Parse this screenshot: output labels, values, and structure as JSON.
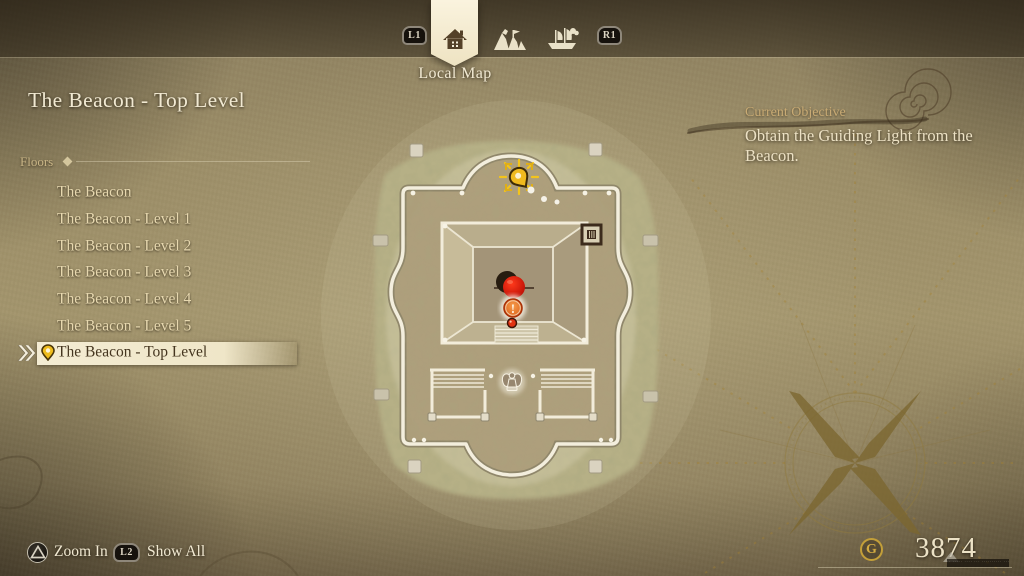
{
  "header": {
    "left_bumper_label": "L1",
    "right_bumper_label": "R1",
    "tab_label": "Local Map",
    "tabs": [
      {
        "name": "local-map",
        "icon": "house-icon",
        "selected": true
      },
      {
        "name": "area-map",
        "icon": "mountain-icon",
        "selected": false
      },
      {
        "name": "world-map",
        "icon": "ship-icon",
        "selected": false
      }
    ]
  },
  "page_title": "The Beacon - Top Level",
  "floors": {
    "heading": "Floors",
    "items": [
      {
        "label": "The Beacon",
        "selected": false
      },
      {
        "label": "The Beacon - Level 1",
        "selected": false
      },
      {
        "label": "The Beacon - Level 2",
        "selected": false
      },
      {
        "label": "The Beacon - Level 3",
        "selected": false
      },
      {
        "label": "The Beacon - Level 4",
        "selected": false
      },
      {
        "label": "The Beacon - Level 5",
        "selected": false
      },
      {
        "label": "The Beacon - Top Level",
        "selected": true
      }
    ]
  },
  "objective": {
    "heading": "Current Objective",
    "text": "Obtain the Guiding Light from the Beacon."
  },
  "map": {
    "markers": [
      {
        "name": "tracked-destination-pin"
      },
      {
        "name": "target-marker"
      },
      {
        "name": "objective-exclamation-marker"
      },
      {
        "name": "player-position-dot"
      },
      {
        "name": "statue-icon"
      },
      {
        "name": "door-icon"
      }
    ]
  },
  "footer": {
    "zoom_in_button": "triangle",
    "zoom_in_label": "Zoom In",
    "show_all_button": "L2",
    "show_all_label": "Show All",
    "currency_icon": "G",
    "currency_amount": "3874",
    "fine_print": "·· ····· ···· ··· ·········· ··· ····"
  },
  "colors": {
    "accent_cream": "#f3ecd6",
    "highlight_bar": "#f1e8cd",
    "gold_pin": "#edb91f",
    "alert_red": "#d61a0e",
    "objective_orange": "#e06a1e",
    "gil_gold": "#c9a43c"
  }
}
